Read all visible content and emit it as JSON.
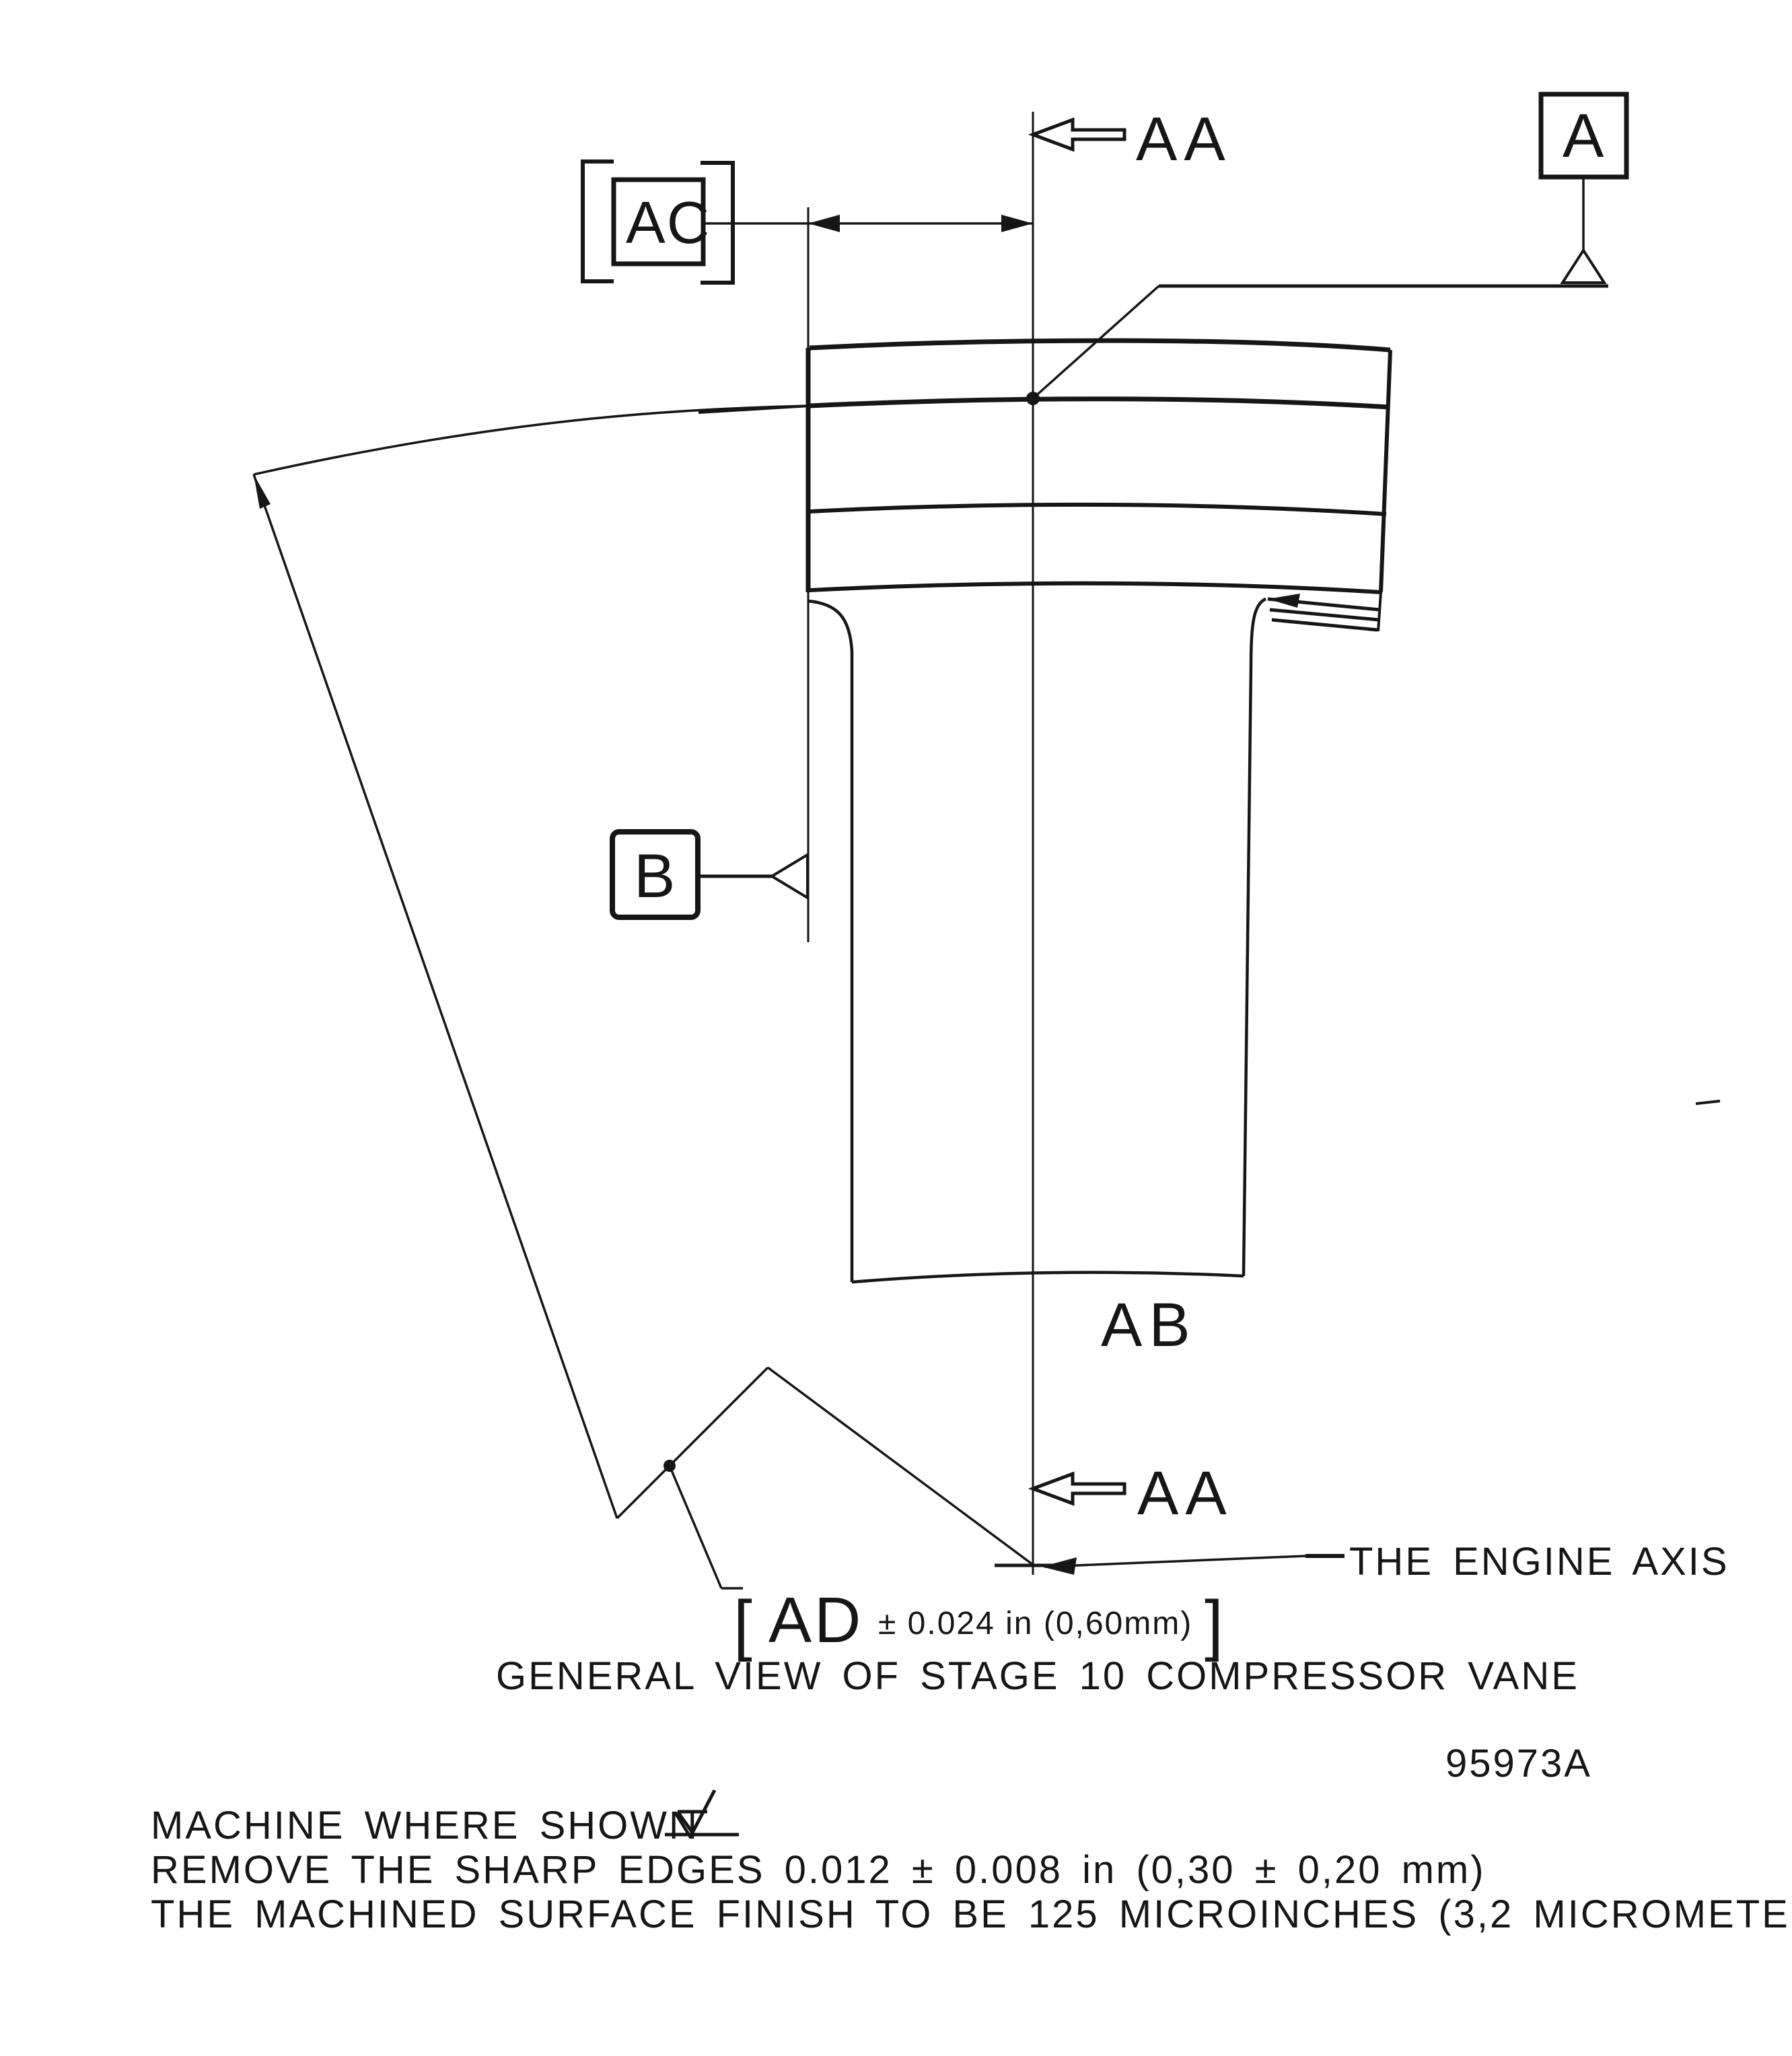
{
  "colors": {
    "ink": "#161616",
    "paper": "#ffffff"
  },
  "drawing": {
    "section_marker_top": "AA",
    "section_marker_bottom": "AA",
    "datum_a_label": "A",
    "datum_b_label": "B",
    "basic_dim_label": "AC",
    "section_plane_label": "AB",
    "engine_axis_label": "THE ENGINE AXIS",
    "radius_callout": {
      "open_bracket": "[",
      "dim_name": "AD",
      "tolerance": "± 0.024 in (0,60mm)",
      "close_bracket": "]"
    },
    "caption": "GENERAL VIEW OF STAGE 10 COMPRESSOR VANE",
    "drawing_number": "95973A",
    "notes": {
      "line1": "MACHINE WHERE SHOWN",
      "line2": "REMOVE THE SHARP EDGES  0.012 ± 0.008 in (0,30 ± 0,20 mm)",
      "line3": "THE MACHINED SURFACE FINISH TO BE 125 MICROINCHES (3,2 MICROMETERS)"
    }
  }
}
